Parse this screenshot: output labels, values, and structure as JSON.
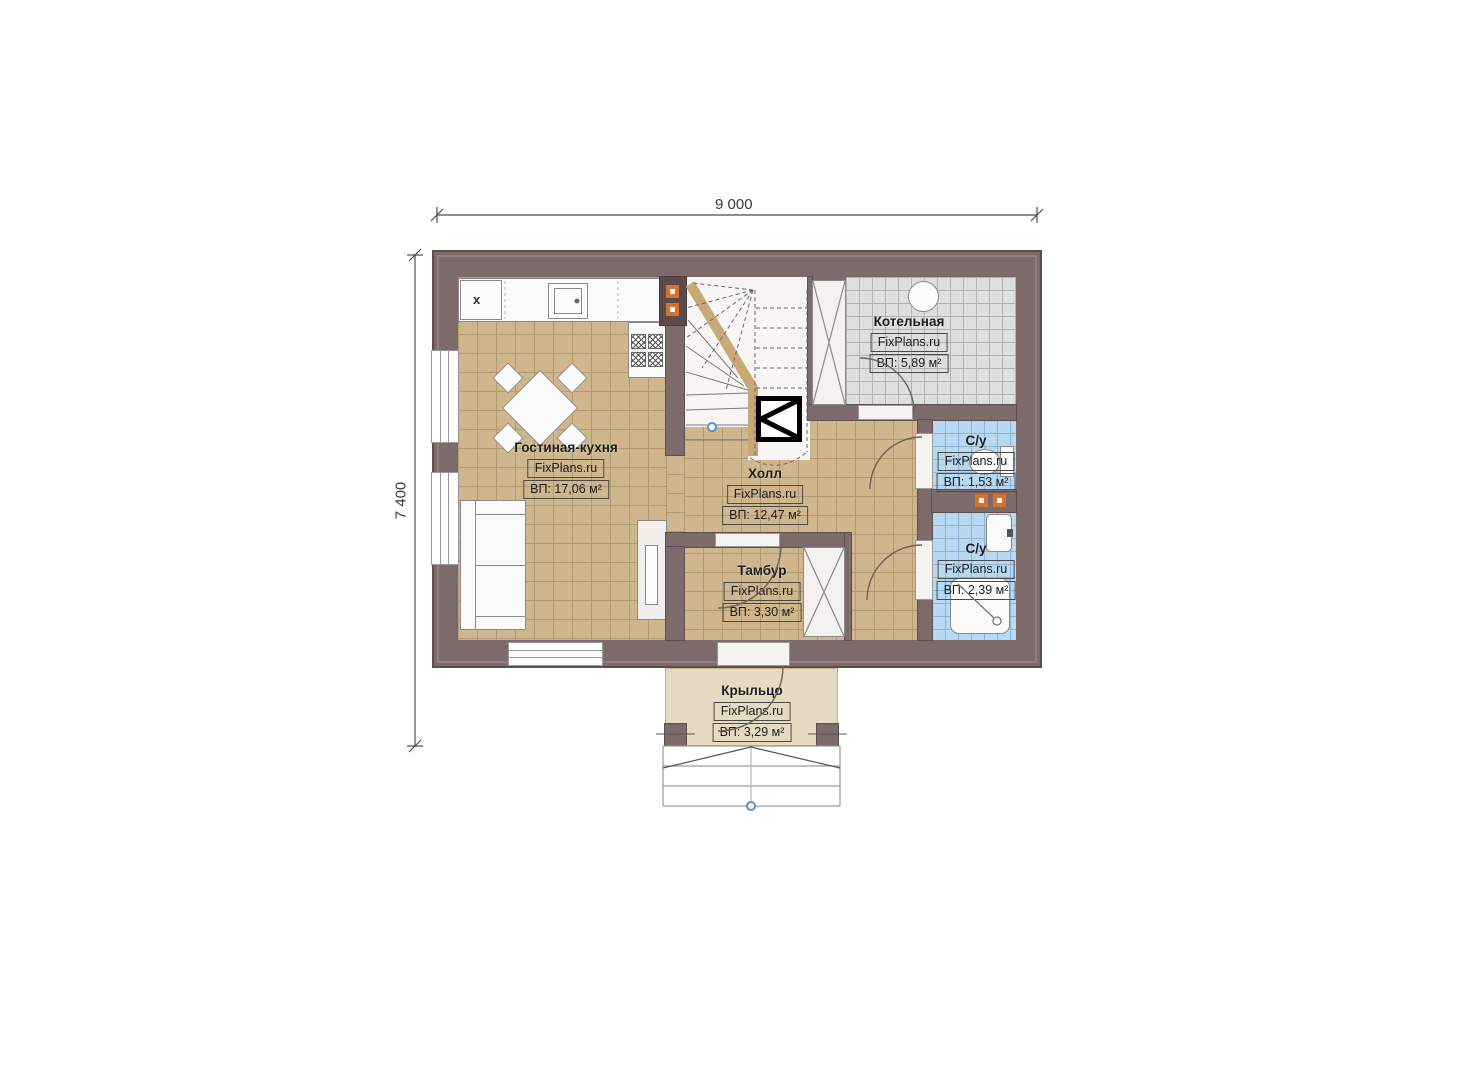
{
  "dimensions": {
    "width_label": "9 000",
    "height_label": "7 400"
  },
  "rooms": [
    {
      "name": "Гостиная-кухня",
      "brand": "FixPlans.ru",
      "area": "ВП: 17,06 м²"
    },
    {
      "name": "Холл",
      "brand": "FixPlans.ru",
      "area": "ВП: 12,47 м²"
    },
    {
      "name": "Котельная",
      "brand": "FixPlans.ru",
      "area": "ВП: 5,89 м²"
    },
    {
      "name": "С/у",
      "brand": "FixPlans.ru",
      "area": "ВП: 1,53 м²"
    },
    {
      "name": "С/у",
      "brand": "FixPlans.ru",
      "area": "ВП: 2,39 м²"
    },
    {
      "name": "Тамбур",
      "brand": "FixPlans.ru",
      "area": "ВП: 3,30 м²"
    },
    {
      "name": "Крыльцо",
      "brand": "FixPlans.ru",
      "area": "ВП: 3,29 м²"
    }
  ],
  "annotations": {
    "kitchen_appliance": "x"
  },
  "colors": {
    "wall": "#7d6b6b",
    "floor_tan": "#cfb68c",
    "tile_gray": "#dedede",
    "tile_blue": "#b7d8f1",
    "porch": "#e6dac2",
    "flue_orange": "#dd6f2d"
  }
}
